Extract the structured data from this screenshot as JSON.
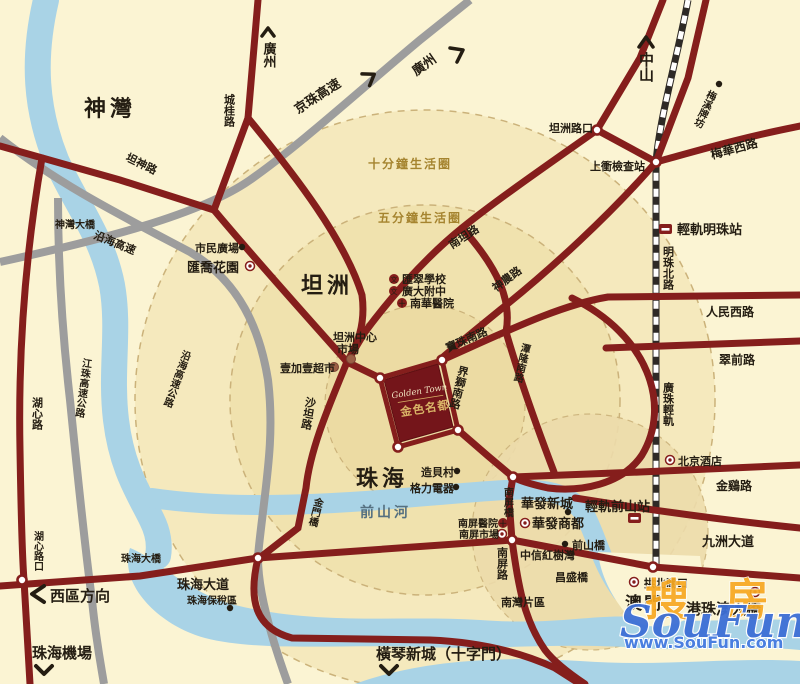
{
  "areas": {
    "shenwan": "神灣",
    "tanzhou": "坦洲",
    "zhuhai": "珠海",
    "aomen": "澳門",
    "nanwan": "南灣片區"
  },
  "rivers": {
    "qianshan_river": "前山河"
  },
  "circles": {
    "ten_min": "十分鐘生活圈",
    "five_min": "五分鐘生活圈"
  },
  "roads": {
    "chenggui": "城桂路",
    "tanshen": "坦神路",
    "nantan": "南坦路",
    "shennong": "神農路",
    "baozhu": "寶珠南路",
    "tanlong": "潭隆南路",
    "jieshi": "界獅南路",
    "shatan": "沙坦路",
    "meihua": "梅華西路",
    "mingzhu_rd": "明珠北路",
    "renmin": "人民西路",
    "cuiqian": "翠前路",
    "jinji": "金鷄路",
    "jiuzhou": "九洲大道",
    "zhuhai_ave": "珠海大道",
    "nanping_rd": "南屏路",
    "huxin": "湖心路"
  },
  "highways": {
    "jingzhu": "京珠高速",
    "yanhai": "沿海高速",
    "yanhai_full": "沿海高速公路",
    "jiangzhu": "江珠高速公路",
    "guangzhu_rail": "廣珠輕軌"
  },
  "junctions": {
    "tanzhou_jct": "坦洲路口",
    "shangchong": "上衝檢查站",
    "huxin_jct": "湖心路口",
    "gongbei": "拱北關口"
  },
  "stations": {
    "mingzhu_st": "輕軌明珠站",
    "qianshan_st": "輕軌前山站"
  },
  "bridges": {
    "shenwan_br": "神灣大橋",
    "zhuhai_br": "珠海大橋",
    "jinmen_br": "金門橋",
    "nanping_br": "南屏橋",
    "qianshan_br": "前山橋",
    "changsheng_br": "昌盛橋",
    "hzm_br": "港珠澳大橋"
  },
  "pois": {
    "shimin": "市民廣場",
    "huiqiao": "匯喬花園",
    "tz_market1": "坦洲中心",
    "tz_market2": "市場",
    "yijiayi": "壹加壹超市",
    "huicui": "匯翠學校",
    "guangda": "廣大附中",
    "nanhua": "南華醫院",
    "zaobei": "造貝村",
    "geli": "格力電器",
    "np_hospital": "南屏醫院",
    "np_market": "南屏市場",
    "huafa_xc": "華發新城",
    "huafa_sd": "華發商都",
    "zhongxin": "中信紅樹灣",
    "beijing_hotel": "北京酒店",
    "bonded": "珠海保稅區",
    "meixi": "梅溪牌坊"
  },
  "directions": {
    "guangzhou": "廣州",
    "zhongshan": "中山",
    "xiqu": "西區方向",
    "airport": "珠海機場",
    "hengqin": "橫琴新城（十字門）"
  },
  "property": {
    "name_en": "Golden Town",
    "name_cn": "金色名都"
  },
  "icons": {
    "school_glyph": "文",
    "hospital_glyph": "十"
  },
  "watermark": {
    "brand_cn_1": "搜",
    "brand_cn_2": "房",
    "brand_en": "SouFun",
    "url": "www.SouFun.com"
  },
  "colors": {
    "road": "#851e1c",
    "highway": "#9d9d9d",
    "water": "#a9d3e6",
    "property_block": "#74151a",
    "accent_gold": "#d9b467",
    "background": "#fbf4d3"
  }
}
